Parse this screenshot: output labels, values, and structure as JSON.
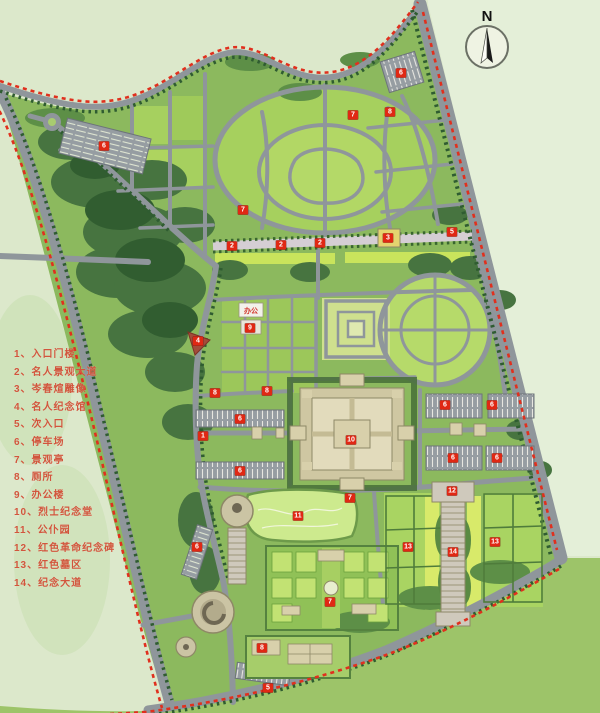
{
  "map": {
    "north_label": "N",
    "office_label": "办公"
  },
  "legend": {
    "items": [
      "1、入口门楼",
      "2、名人景观大道",
      "3、岑春煊雕像",
      "4、名人纪念馆",
      "5、次入口",
      "6、停车场",
      "7、景观亭",
      "8、厕所",
      "9、办公楼",
      "10、烈士纪念堂",
      "11、公仆园",
      "12、红色革命纪念碑",
      "13、红色墓区",
      "14、纪念大道"
    ]
  },
  "markers": [
    {
      "n": "6",
      "x": 104,
      "y": 146
    },
    {
      "n": "6",
      "x": 401,
      "y": 73
    },
    {
      "n": "7",
      "x": 353,
      "y": 115
    },
    {
      "n": "8",
      "x": 390,
      "y": 112
    },
    {
      "n": "7",
      "x": 243,
      "y": 210
    },
    {
      "n": "2",
      "x": 232,
      "y": 246
    },
    {
      "n": "2",
      "x": 281,
      "y": 245
    },
    {
      "n": "2",
      "x": 320,
      "y": 243
    },
    {
      "n": "3",
      "x": 388,
      "y": 238
    },
    {
      "n": "5",
      "x": 452,
      "y": 232
    },
    {
      "n": "4",
      "x": 198,
      "y": 341
    },
    {
      "n": "9",
      "x": 250,
      "y": 328
    },
    {
      "n": "8",
      "x": 215,
      "y": 393
    },
    {
      "n": "8",
      "x": 267,
      "y": 391
    },
    {
      "n": "1",
      "x": 203,
      "y": 436
    },
    {
      "n": "6",
      "x": 240,
      "y": 419
    },
    {
      "n": "6",
      "x": 240,
      "y": 471
    },
    {
      "n": "6",
      "x": 445,
      "y": 405
    },
    {
      "n": "6",
      "x": 492,
      "y": 405
    },
    {
      "n": "6",
      "x": 453,
      "y": 458
    },
    {
      "n": "6",
      "x": 497,
      "y": 458
    },
    {
      "n": "10",
      "x": 351,
      "y": 440
    },
    {
      "n": "7",
      "x": 350,
      "y": 498
    },
    {
      "n": "11",
      "x": 298,
      "y": 516
    },
    {
      "n": "6",
      "x": 197,
      "y": 547
    },
    {
      "n": "12",
      "x": 452,
      "y": 491
    },
    {
      "n": "13",
      "x": 408,
      "y": 547
    },
    {
      "n": "13",
      "x": 495,
      "y": 542
    },
    {
      "n": "14",
      "x": 453,
      "y": 552
    },
    {
      "n": "7",
      "x": 330,
      "y": 602
    },
    {
      "n": "8",
      "x": 262,
      "y": 648
    },
    {
      "n": "5",
      "x": 268,
      "y": 688
    }
  ],
  "colors": {
    "boundary_dash": "#e0301e",
    "legend_text": "#d2553c",
    "road": "#8f969b",
    "lawn": "#9cc75a",
    "building": "#d8d1b0"
  }
}
